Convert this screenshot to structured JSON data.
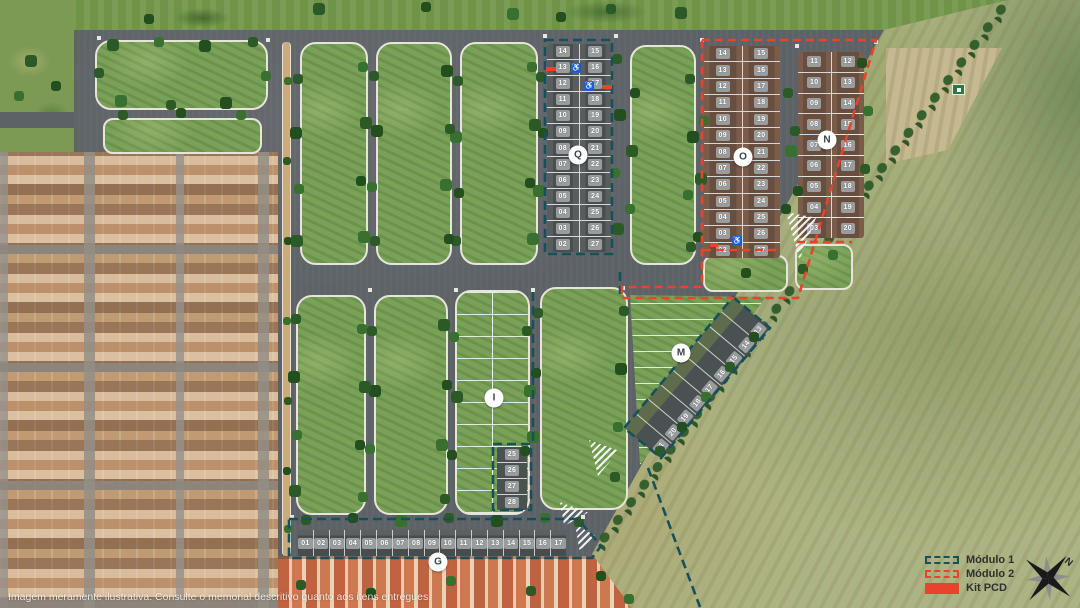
{
  "disclaimer": "Imagem meramente ilustrativa. Consulte o memorial descritivo quanto aos itens entregues.",
  "compass": {
    "north_label": "N"
  },
  "icons": {
    "pcd": "♿"
  },
  "colors": {
    "module1": "#17505a",
    "module2": "#e8432c",
    "kit_pcd": "#e8432c"
  },
  "legend": {
    "items": [
      {
        "label": "Módulo 1",
        "style": "dashed-teal"
      },
      {
        "label": "Módulo 2",
        "style": "dashed-red"
      },
      {
        "label": "Kit  PCD",
        "style": "solid-red"
      }
    ]
  },
  "blocks": {
    "q": {
      "label": "Q",
      "rows": [
        {
          "l": "14",
          "r": "15"
        },
        {
          "l": "13",
          "r": "16"
        },
        {
          "l": "12",
          "r": "17"
        },
        {
          "l": "11",
          "r": "18"
        },
        {
          "l": "10",
          "r": "19"
        },
        {
          "l": "09",
          "r": "20"
        },
        {
          "l": "08",
          "r": "21"
        },
        {
          "l": "07",
          "r": "22"
        },
        {
          "l": "06",
          "r": "23"
        },
        {
          "l": "05",
          "r": "24"
        },
        {
          "l": "04",
          "r": "25"
        },
        {
          "l": "03",
          "r": "26"
        },
        {
          "l": "02",
          "r": "27"
        }
      ]
    },
    "o": {
      "label": "O",
      "rows": [
        {
          "l": "14",
          "r": "15"
        },
        {
          "l": "13",
          "r": "16"
        },
        {
          "l": "12",
          "r": "17"
        },
        {
          "l": "11",
          "r": "18"
        },
        {
          "l": "10",
          "r": "19"
        },
        {
          "l": "09",
          "r": "20"
        },
        {
          "l": "08",
          "r": "21"
        },
        {
          "l": "07",
          "r": "22"
        },
        {
          "l": "06",
          "r": "23"
        },
        {
          "l": "05",
          "r": "24"
        },
        {
          "l": "04",
          "r": "25"
        },
        {
          "l": "03",
          "r": "26"
        },
        {
          "l": "02",
          "r": "27"
        }
      ]
    },
    "n": {
      "label": "N",
      "rows": [
        {
          "l": "11",
          "r": "12"
        },
        {
          "l": "10",
          "r": "13"
        },
        {
          "l": "09",
          "r": "14"
        },
        {
          "l": "08",
          "r": "15"
        },
        {
          "l": "07",
          "r": "16"
        },
        {
          "l": "06",
          "r": "17"
        },
        {
          "l": "05",
          "r": "18"
        },
        {
          "l": "04",
          "r": "19"
        },
        {
          "l": "03",
          "r": "20"
        }
      ]
    },
    "m": {
      "label": "M",
      "lots_sw_to_ne": [
        "21",
        "20",
        "19",
        "18",
        "17",
        "16",
        "15",
        "14",
        "13"
      ]
    },
    "i": {
      "label": "I",
      "lots": [
        "25",
        "26",
        "27",
        "28"
      ]
    },
    "g": {
      "label": "G",
      "lots": [
        "01",
        "02",
        "03",
        "04",
        "05",
        "06",
        "07",
        "08",
        "09",
        "10",
        "11",
        "12",
        "13",
        "14",
        "15",
        "16",
        "17"
      ]
    }
  }
}
